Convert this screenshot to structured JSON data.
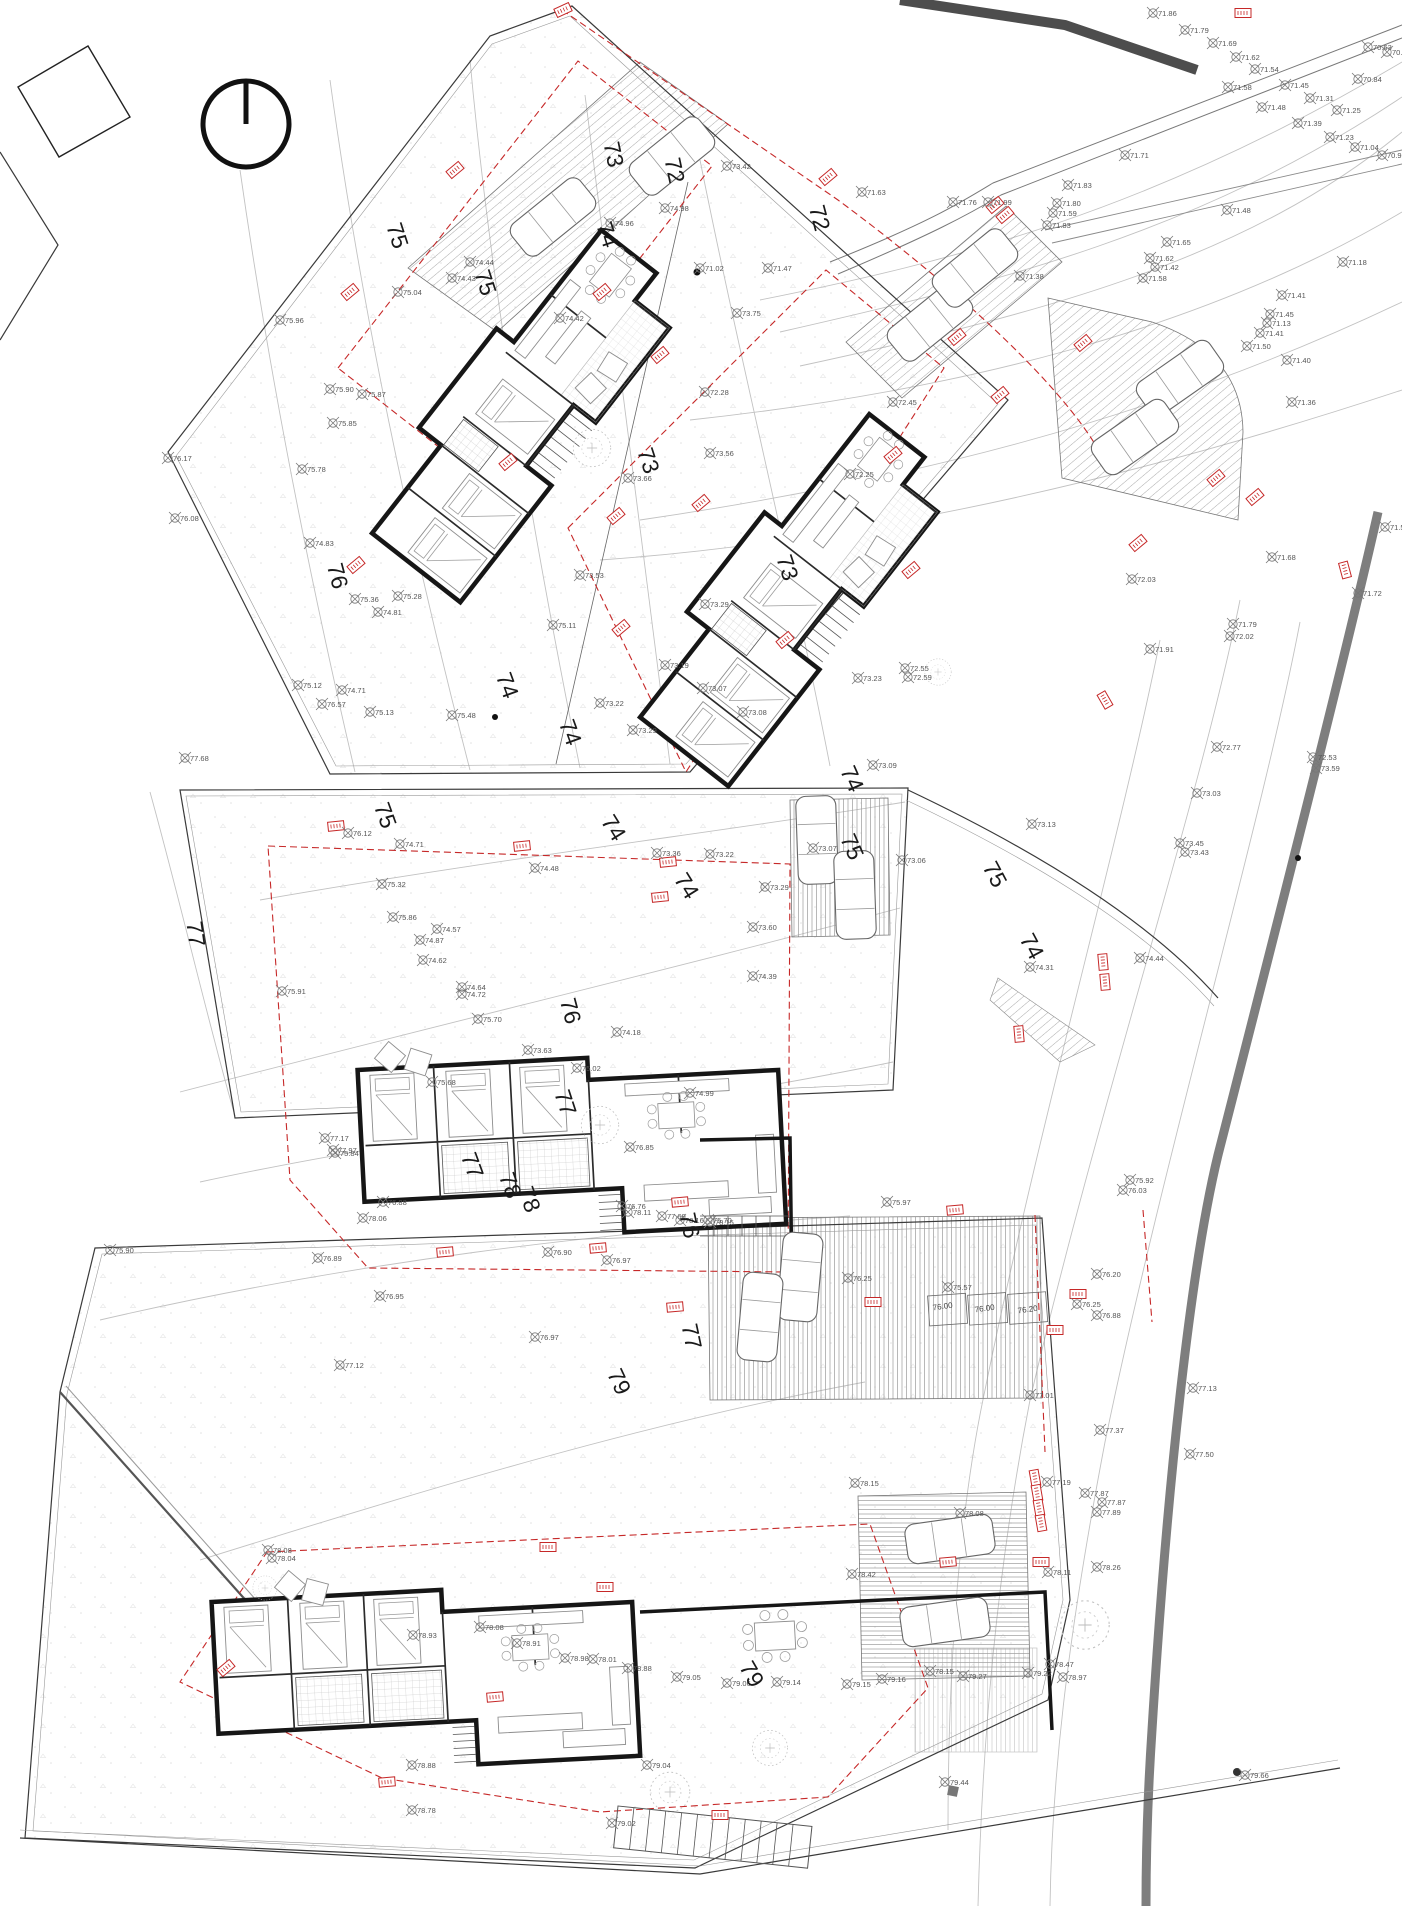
{
  "site_plan": {
    "description_labels": {
      "north_symbol": "north-arrow",
      "road_color": "#7e7e7e",
      "setback_color": "#c62828"
    },
    "contour_labels": [
      [
        "73",
        606,
        156,
        78
      ],
      [
        "72",
        667,
        172,
        78
      ],
      [
        "72",
        812,
        220,
        75
      ],
      [
        "75",
        390,
        238,
        72
      ],
      [
        "75",
        478,
        285,
        72
      ],
      [
        "74",
        600,
        237,
        72
      ],
      [
        "73",
        641,
        463,
        72
      ],
      [
        "73",
        780,
        570,
        72
      ],
      [
        "76",
        330,
        578,
        75
      ],
      [
        "74",
        500,
        688,
        70
      ],
      [
        "74",
        563,
        735,
        70
      ],
      [
        "74",
        607,
        832,
        58
      ],
      [
        "74",
        680,
        890,
        58
      ],
      [
        "74",
        845,
        782,
        66
      ],
      [
        "75",
        378,
        818,
        70
      ],
      [
        "75",
        845,
        850,
        66
      ],
      [
        "75",
        988,
        878,
        62
      ],
      [
        "74",
        1025,
        950,
        62
      ],
      [
        "77",
        188,
        935,
        82
      ],
      [
        "76",
        563,
        1013,
        75
      ],
      [
        "76",
        682,
        1227,
        78
      ],
      [
        "77",
        558,
        1105,
        72
      ],
      [
        "77",
        465,
        1168,
        70
      ],
      [
        "77",
        684,
        1338,
        78
      ],
      [
        "78",
        503,
        1188,
        70
      ],
      [
        "78",
        522,
        1202,
        70
      ],
      [
        "79",
        612,
        1385,
        65
      ],
      [
        "79",
        745,
        1678,
        60
      ]
    ],
    "survey_points": [
      [
        1153,
        13,
        "71.86"
      ],
      [
        1185,
        30,
        "71.79"
      ],
      [
        1213,
        43,
        "71.69"
      ],
      [
        1236,
        57,
        "71.62"
      ],
      [
        1255,
        69,
        "71.54"
      ],
      [
        1285,
        85,
        "71.45"
      ],
      [
        1310,
        98,
        "71.31"
      ],
      [
        1337,
        110,
        "71.25"
      ],
      [
        1368,
        47,
        "70.63"
      ],
      [
        1387,
        52,
        "70.58"
      ],
      [
        1358,
        79,
        "70.84"
      ],
      [
        1228,
        87,
        "71.58"
      ],
      [
        1262,
        107,
        "71.48"
      ],
      [
        1298,
        123,
        "71.39"
      ],
      [
        1330,
        137,
        "71.23"
      ],
      [
        1355,
        147,
        "71.04"
      ],
      [
        1382,
        155,
        "70.93"
      ],
      [
        1125,
        155,
        "71.71"
      ],
      [
        1068,
        185,
        "71.83"
      ],
      [
        1057,
        203,
        "71.80"
      ],
      [
        1053,
        213,
        "71.59"
      ],
      [
        1047,
        225,
        "71.83"
      ],
      [
        1227,
        210,
        "71.48"
      ],
      [
        1167,
        242,
        "71.65"
      ],
      [
        1150,
        258,
        "71.62"
      ],
      [
        1155,
        267,
        "71.42"
      ],
      [
        1143,
        278,
        "71.58"
      ],
      [
        1020,
        276,
        "71.38"
      ],
      [
        1282,
        295,
        "71.41"
      ],
      [
        1343,
        262,
        "71.18"
      ],
      [
        1270,
        314,
        "71.45"
      ],
      [
        1267,
        323,
        "71.13"
      ],
      [
        1260,
        333,
        "71.41"
      ],
      [
        1247,
        346,
        "71.50"
      ],
      [
        1287,
        360,
        "71.40"
      ],
      [
        1292,
        402,
        "71.36"
      ],
      [
        953,
        202,
        "71.76"
      ],
      [
        988,
        202,
        "71.99"
      ],
      [
        862,
        192,
        "71.63"
      ],
      [
        1132,
        579,
        "72.03"
      ],
      [
        1385,
        527,
        "71.55"
      ],
      [
        1358,
        593,
        "71.72"
      ],
      [
        1272,
        557,
        "71.68"
      ],
      [
        1233,
        624,
        "71.79"
      ],
      [
        1230,
        636,
        "72.02"
      ],
      [
        1150,
        649,
        "71.91"
      ],
      [
        1217,
        747,
        "72.77"
      ],
      [
        1313,
        757,
        "72.53"
      ],
      [
        1316,
        768,
        "73.59"
      ],
      [
        1197,
        793,
        "73.03"
      ],
      [
        1032,
        824,
        "73.13"
      ],
      [
        1180,
        843,
        "73.45"
      ],
      [
        1185,
        852,
        "73.43"
      ],
      [
        700,
        268,
        "71.02"
      ],
      [
        768,
        268,
        "71.47"
      ],
      [
        727,
        166,
        "73.42"
      ],
      [
        665,
        208,
        "74.98"
      ],
      [
        610,
        223,
        "74.96"
      ],
      [
        560,
        318,
        "74.42"
      ],
      [
        737,
        313,
        "73.75"
      ],
      [
        705,
        392,
        "72.28"
      ],
      [
        628,
        478,
        "73.66"
      ],
      [
        710,
        453,
        "73.56"
      ],
      [
        850,
        474,
        "72.25"
      ],
      [
        580,
        575,
        "73.53"
      ],
      [
        705,
        604,
        "73.29"
      ],
      [
        665,
        665,
        "73.19"
      ],
      [
        893,
        402,
        "72.45"
      ],
      [
        905,
        668,
        "72.55"
      ],
      [
        908,
        677,
        "72.59"
      ],
      [
        470,
        262,
        "74.44"
      ],
      [
        452,
        278,
        "74.43"
      ],
      [
        398,
        292,
        "75.04"
      ],
      [
        280,
        320,
        "75.96"
      ],
      [
        168,
        458,
        "76.17"
      ],
      [
        175,
        518,
        "76.08"
      ],
      [
        330,
        389,
        "75.90"
      ],
      [
        362,
        394,
        "75.87"
      ],
      [
        333,
        423,
        "75.85"
      ],
      [
        302,
        469,
        "75.78"
      ],
      [
        310,
        543,
        "74.83"
      ],
      [
        355,
        599,
        "75.36"
      ],
      [
        398,
        596,
        "75.28"
      ],
      [
        370,
        712,
        "75.13"
      ],
      [
        322,
        704,
        "76.57"
      ],
      [
        298,
        685,
        "75.12"
      ],
      [
        342,
        690,
        "74.71"
      ],
      [
        452,
        715,
        "75.48"
      ],
      [
        378,
        612,
        "74.81"
      ],
      [
        553,
        625,
        "75.11"
      ],
      [
        600,
        703,
        "73.22"
      ],
      [
        633,
        730,
        "73.29"
      ],
      [
        703,
        688,
        "73.07"
      ],
      [
        743,
        712,
        "73.08"
      ],
      [
        858,
        678,
        "73.23"
      ],
      [
        185,
        758,
        "77.68"
      ],
      [
        348,
        833,
        "76.12"
      ],
      [
        400,
        844,
        "74.71"
      ],
      [
        535,
        868,
        "74.48"
      ],
      [
        382,
        884,
        "75.32"
      ],
      [
        393,
        917,
        "75.86"
      ],
      [
        437,
        929,
        "74.57"
      ],
      [
        420,
        940,
        "74.87"
      ],
      [
        423,
        960,
        "74.62"
      ],
      [
        462,
        987,
        "74.64"
      ],
      [
        462,
        994,
        "74.72"
      ],
      [
        478,
        1019,
        "75.70"
      ],
      [
        282,
        991,
        "75.91"
      ],
      [
        657,
        853,
        "73.36"
      ],
      [
        710,
        854,
        "73.22"
      ],
      [
        617,
        1032,
        "74.18"
      ],
      [
        528,
        1050,
        "73.63"
      ],
      [
        577,
        1068,
        "75.02"
      ],
      [
        690,
        1093,
        "74.99"
      ],
      [
        432,
        1082,
        "75.68"
      ],
      [
        873,
        765,
        "73.09"
      ],
      [
        813,
        848,
        "73.07"
      ],
      [
        902,
        860,
        "73.06"
      ],
      [
        765,
        887,
        "73.29"
      ],
      [
        753,
        927,
        "73.60"
      ],
      [
        753,
        976,
        "74.39"
      ],
      [
        1030,
        967,
        "74.31"
      ],
      [
        1140,
        958,
        "74.44"
      ],
      [
        335,
        1153,
        "75.84"
      ],
      [
        383,
        1202,
        "76.88"
      ],
      [
        318,
        1258,
        "76.89"
      ],
      [
        380,
        1296,
        "76.95"
      ],
      [
        535,
        1337,
        "76.97"
      ],
      [
        340,
        1365,
        "77.12"
      ],
      [
        548,
        1252,
        "76.90"
      ],
      [
        607,
        1260,
        "76.97"
      ],
      [
        622,
        1206,
        "76.76"
      ],
      [
        708,
        1220,
        "75.70"
      ],
      [
        630,
        1147,
        "76.85"
      ],
      [
        887,
        1202,
        "75.97"
      ],
      [
        848,
        1278,
        "76.25"
      ],
      [
        1130,
        1180,
        "75.92"
      ],
      [
        1123,
        1190,
        "76.03"
      ],
      [
        1097,
        1274,
        "76.20"
      ],
      [
        948,
        1287,
        "75.57"
      ],
      [
        1077,
        1304,
        "76.25"
      ],
      [
        1097,
        1315,
        "76.88"
      ],
      [
        1030,
        1395,
        "77.01"
      ],
      [
        1100,
        1430,
        "77.37"
      ],
      [
        1190,
        1454,
        "77.50"
      ],
      [
        1193,
        1388,
        "77.13"
      ],
      [
        325,
        1138,
        "77.17"
      ],
      [
        333,
        1150,
        "77.97"
      ],
      [
        363,
        1218,
        "78.06"
      ],
      [
        110,
        1250,
        "75.90"
      ],
      [
        628,
        1212,
        "78.11"
      ],
      [
        662,
        1216,
        "77.69"
      ],
      [
        680,
        1220,
        "78.16"
      ],
      [
        710,
        1222,
        "78.15"
      ],
      [
        855,
        1483,
        "78.15"
      ],
      [
        1047,
        1482,
        "77.19"
      ],
      [
        1085,
        1493,
        "77.87"
      ],
      [
        1102,
        1502,
        "77.87"
      ],
      [
        1097,
        1512,
        "77.89"
      ],
      [
        1048,
        1572,
        "78.11"
      ],
      [
        1097,
        1567,
        "78.26"
      ],
      [
        852,
        1574,
        "78.42"
      ],
      [
        960,
        1513,
        "78.08"
      ],
      [
        1050,
        1664,
        "78.47"
      ],
      [
        1063,
        1677,
        "78.97"
      ],
      [
        847,
        1684,
        "79.15"
      ],
      [
        882,
        1679,
        "79.16"
      ],
      [
        930,
        1671,
        "78.15"
      ],
      [
        963,
        1676,
        "79.27"
      ],
      [
        1028,
        1673,
        "79.22"
      ],
      [
        268,
        1550,
        "78.08"
      ],
      [
        272,
        1558,
        "78.04"
      ],
      [
        413,
        1635,
        "78.93"
      ],
      [
        480,
        1627,
        "78.08"
      ],
      [
        517,
        1643,
        "78.91"
      ],
      [
        565,
        1658,
        "78.98"
      ],
      [
        593,
        1659,
        "78.01"
      ],
      [
        412,
        1765,
        "78.88"
      ],
      [
        412,
        1810,
        "78.78"
      ],
      [
        612,
        1823,
        "79.02"
      ],
      [
        628,
        1668,
        "78.88"
      ],
      [
        677,
        1677,
        "79.05"
      ],
      [
        727,
        1683,
        "79.06"
      ],
      [
        777,
        1682,
        "79.14"
      ],
      [
        647,
        1765,
        "79.04"
      ],
      [
        945,
        1782,
        "79.44"
      ],
      [
        1245,
        1775,
        "79.66"
      ]
    ],
    "level_labels": [
      [
        "76.00",
        943,
        1309,
        -8
      ],
      [
        "76.00",
        985,
        1311,
        -8
      ],
      [
        "76.20",
        1028,
        1312,
        -8
      ]
    ],
    "red_tags": [
      [
        563,
        10,
        -25
      ],
      [
        1243,
        13,
        0
      ],
      [
        828,
        177,
        -40
      ],
      [
        455,
        170,
        -40
      ],
      [
        350,
        292,
        -40
      ],
      [
        602,
        292,
        -40
      ],
      [
        660,
        355,
        -40
      ],
      [
        893,
        455,
        -40
      ],
      [
        1000,
        395,
        -40
      ],
      [
        616,
        516,
        -40
      ],
      [
        701,
        503,
        -40
      ],
      [
        911,
        570,
        -40
      ],
      [
        356,
        565,
        -40
      ],
      [
        785,
        640,
        -40
      ],
      [
        621,
        628,
        -40
      ],
      [
        508,
        462,
        -40
      ],
      [
        995,
        205,
        -40
      ],
      [
        1005,
        215,
        -40
      ],
      [
        1083,
        343,
        -40
      ],
      [
        957,
        337,
        -40
      ],
      [
        1216,
        478,
        -40
      ],
      [
        1255,
        497,
        -40
      ],
      [
        1138,
        543,
        -40
      ],
      [
        1105,
        700,
        60
      ],
      [
        1103,
        962,
        85
      ],
      [
        1105,
        982,
        85
      ],
      [
        1019,
        1034,
        85
      ],
      [
        336,
        826,
        -6
      ],
      [
        522,
        846,
        -6
      ],
      [
        668,
        862,
        -6
      ],
      [
        660,
        897,
        -6
      ],
      [
        445,
        1252,
        -5
      ],
      [
        598,
        1248,
        -5
      ],
      [
        680,
        1202,
        -5
      ],
      [
        675,
        1307,
        -5
      ],
      [
        955,
        1210,
        -5
      ],
      [
        1078,
        1294,
        0
      ],
      [
        873,
        1302,
        0
      ],
      [
        948,
        1562,
        -5
      ],
      [
        1035,
        1478,
        80
      ],
      [
        1037,
        1493,
        80
      ],
      [
        1039,
        1508,
        80
      ],
      [
        1041,
        1523,
        80
      ],
      [
        1041,
        1562,
        0
      ],
      [
        548,
        1547,
        0
      ],
      [
        226,
        1668,
        -40
      ],
      [
        605,
        1587,
        0
      ],
      [
        495,
        1697,
        -5
      ],
      [
        387,
        1782,
        -5
      ],
      [
        720,
        1815,
        0
      ],
      [
        1055,
        1330,
        0
      ],
      [
        1345,
        570,
        75
      ]
    ],
    "cars": [
      [
        553,
        217,
        -39
      ],
      [
        672,
        156,
        -39
      ],
      [
        930,
        322,
        -39
      ],
      [
        975,
        268,
        -39
      ],
      [
        1180,
        378,
        -35
      ],
      [
        1135,
        437,
        -35
      ],
      [
        817,
        840,
        88
      ],
      [
        855,
        895,
        88
      ],
      [
        800,
        1277,
        95
      ],
      [
        760,
        1317,
        95
      ],
      [
        950,
        1539,
        -8
      ],
      [
        945,
        1622,
        -8
      ]
    ]
  }
}
